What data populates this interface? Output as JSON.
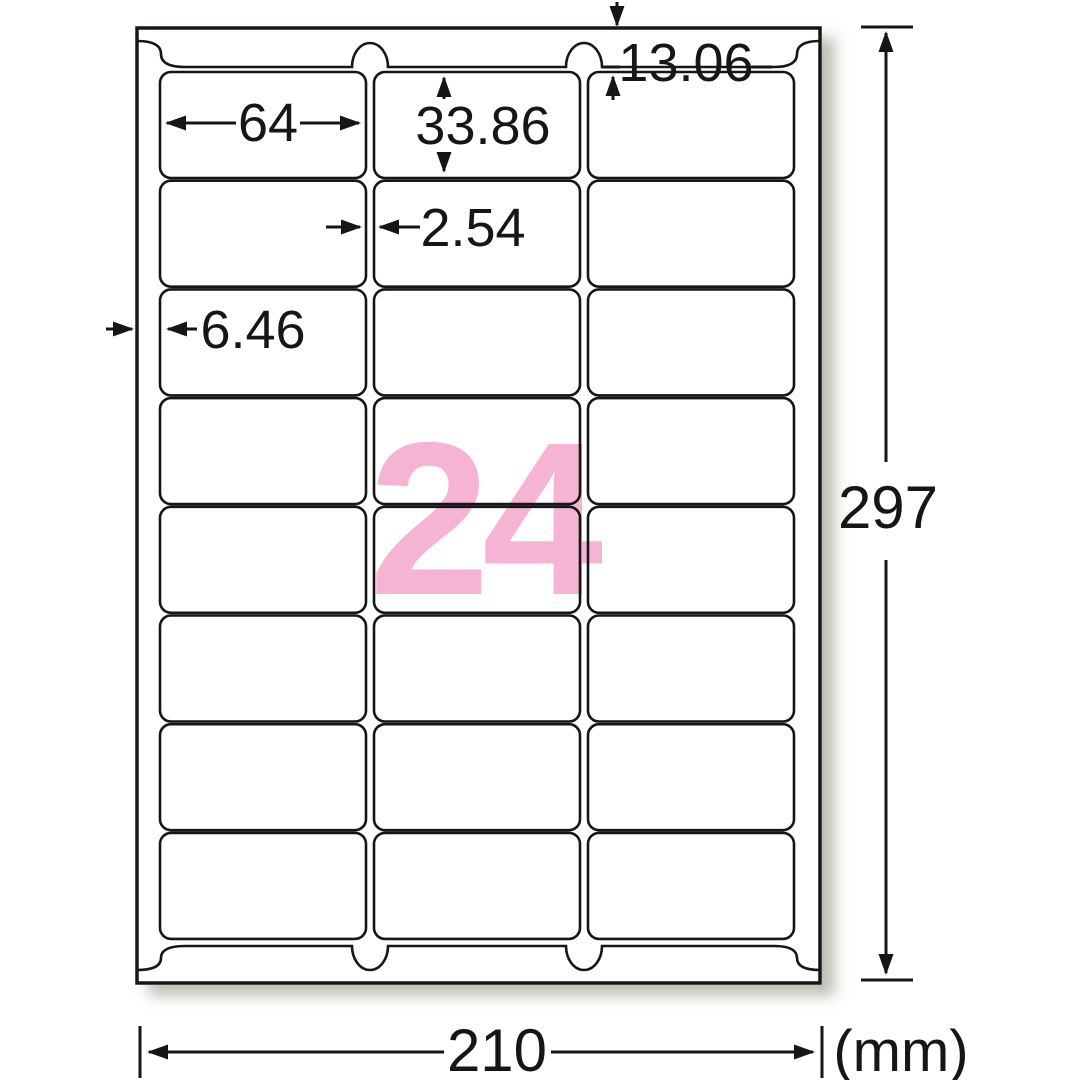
{
  "figure": {
    "title": "label-sheet-dimension-diagram",
    "count_label": "24",
    "unit_label": "(mm)",
    "dims": {
      "top_margin": "13.06",
      "label_width": "64",
      "label_height": "33.86",
      "column_gap": "2.54",
      "side_margin": "6.46",
      "sheet_height": "297",
      "sheet_width": "210"
    },
    "grid": {
      "rows": 8,
      "columns": 3
    },
    "colors": {
      "accent_pink": "#f6b4d4",
      "line_black": "#161616",
      "paper_white": "#ffffff",
      "shadow_gray": "#8a8878"
    }
  }
}
